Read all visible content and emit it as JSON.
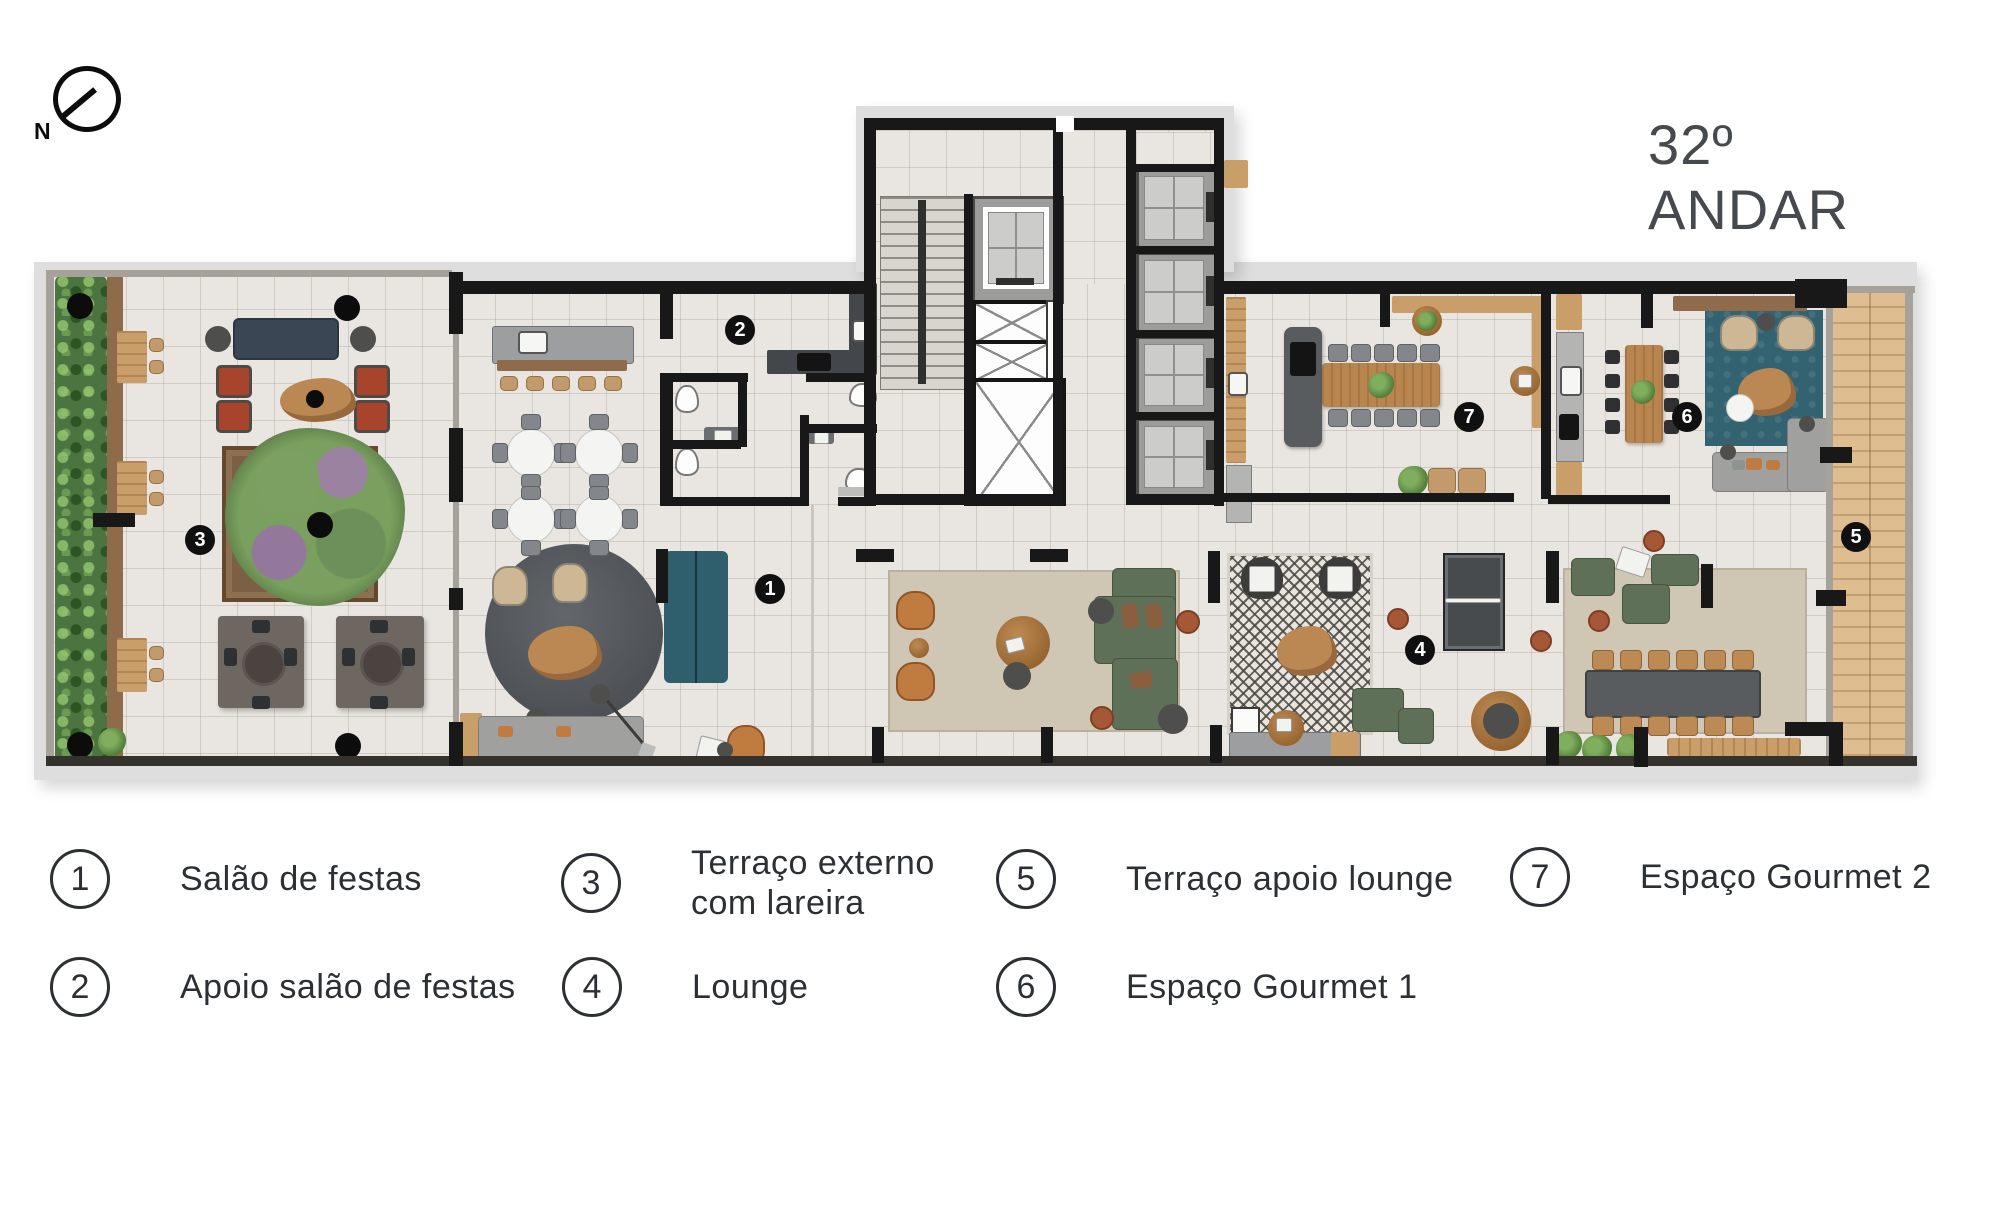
{
  "header": {
    "title": "32º ANDAR"
  },
  "compass": {
    "north_label": "N"
  },
  "legend": {
    "items": [
      {
        "number": "1",
        "label": "Salão de festas"
      },
      {
        "number": "2",
        "label": "Apoio salão de festas"
      },
      {
        "number": "3",
        "label": "Terraço externo\ncom lareira"
      },
      {
        "number": "4",
        "label": "Lounge"
      },
      {
        "number": "5",
        "label": "Terraço apoio lounge"
      },
      {
        "number": "6",
        "label": "Espaço Gourmet 1"
      },
      {
        "number": "7",
        "label": "Espaço Gourmet 2"
      }
    ]
  },
  "colors": {
    "wall": "#181818",
    "floor": "#e9e5e0",
    "hedge_green": "#4c7440",
    "deck_wood": "#debe90",
    "teal": "#2f5e6c",
    "sofa_green": "#5e7057",
    "terracotta": "#a65836",
    "text": "#2c2f33"
  }
}
